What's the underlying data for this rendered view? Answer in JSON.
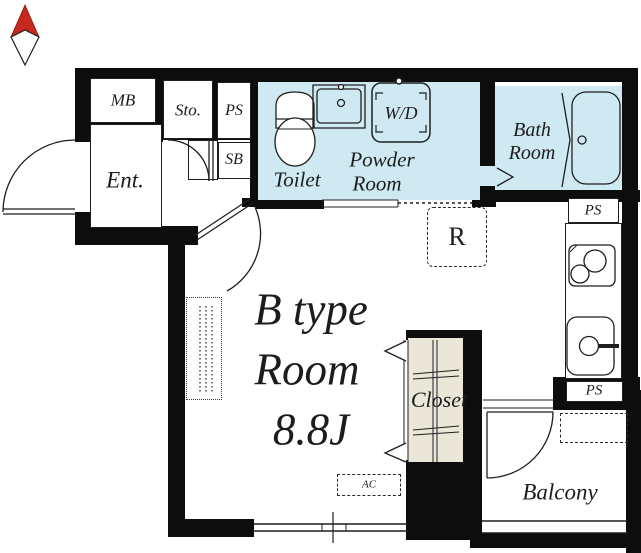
{
  "title": "B type Room 8.8J floor plan",
  "labels": {
    "mb": "MB",
    "sto": "Sto.",
    "ps_top": "PS",
    "sb": "SB",
    "ent": "Ent.",
    "toilet": "Toilet",
    "powder_line1": "Powder",
    "powder_line2": "Room",
    "wd": "W/D",
    "bath_line1": "Bath",
    "bath_line2": "Room",
    "ps_mid": "PS",
    "refrigerator": "R",
    "room_line1": "B type",
    "room_line2": "Room",
    "room_line3": "8.8J",
    "closet": "Closet",
    "ac": "AC",
    "ps_bottom": "PS",
    "balcony": "Balcony"
  },
  "colors": {
    "wall": "#0d0d0d",
    "wet_area": "#cfe9f3",
    "closet_fill": "#eae6d8",
    "line": "#1f1f1f",
    "compass_red": "#c5281e"
  }
}
